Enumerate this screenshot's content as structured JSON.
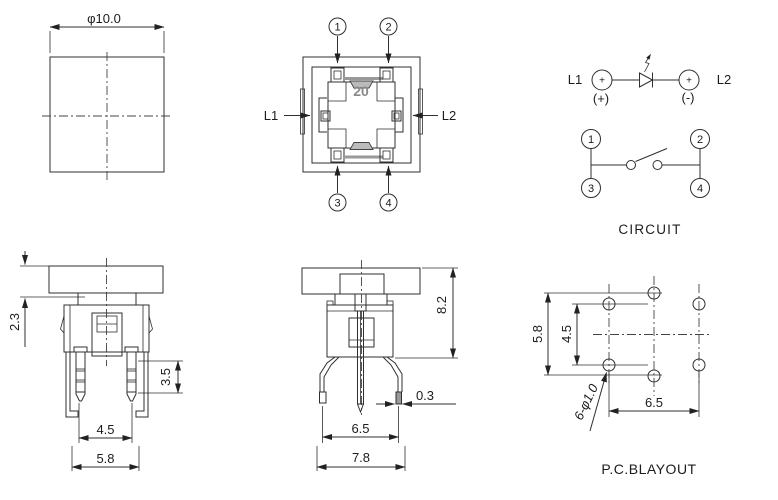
{
  "page": {
    "background": "#ffffff",
    "line_color": "#2f2f2f",
    "text_color": "#1c1c1c"
  },
  "cap_top_view": {
    "diameter_label": "φ10.0"
  },
  "switch_top_view": {
    "marking": "20",
    "pin_callouts": [
      "1",
      "2",
      "3",
      "4"
    ],
    "led_terminal_left": "L1",
    "led_terminal_right": "L2"
  },
  "circuit_view": {
    "title": "CIRCUIT",
    "led": {
      "left_label": "L1",
      "right_label": "L2",
      "left_terminal_sign": "+",
      "right_terminal_sign": "+",
      "left_polarity": "(+)",
      "right_polarity": "(-)"
    },
    "switch_pins": [
      "1",
      "2",
      "3",
      "4"
    ]
  },
  "front_view": {
    "dim_cap_height": "2.3",
    "dim_pin_length": "3.5",
    "dim_pin_pitch": "4.5",
    "dim_body_width": "5.8"
  },
  "side_view": {
    "dim_total_height": "8.2",
    "dim_leg_thickness": "0.3",
    "dim_leg_pitch": "6.5",
    "dim_overall_width": "7.8"
  },
  "pcb_view": {
    "title": "P.C.BLAYOUT",
    "dim_vertical_outer": "5.8",
    "dim_vertical_inner": "4.5",
    "dim_horizontal": "6.5",
    "hole_callout": "6-φ1.0"
  }
}
